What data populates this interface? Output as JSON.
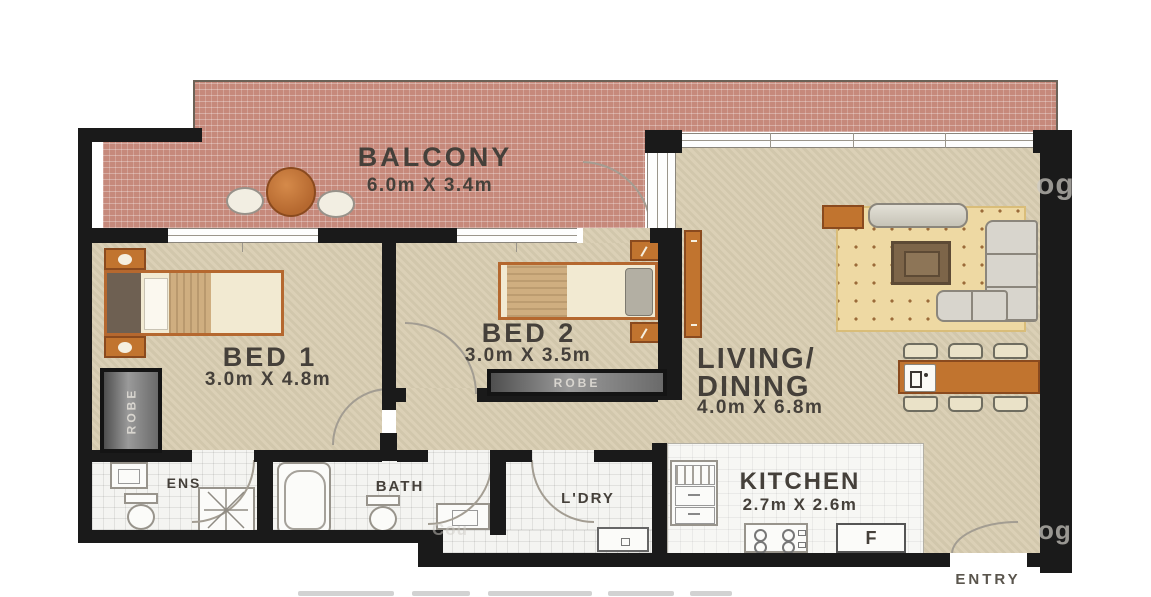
{
  "title": "apartment-floor-plan",
  "rooms": {
    "balcony": {
      "name": "BALCONY",
      "dims": "6.0m X 3.4m"
    },
    "bed1": {
      "name": "BED 1",
      "dims": "3.0m X 4.8m"
    },
    "bed2": {
      "name": "BED 2",
      "dims": "3.0m X 3.5m"
    },
    "living": {
      "name_line1": "LIVING/",
      "name_line2": "DINING",
      "dims": "4.0m X 6.8m"
    },
    "kitchen": {
      "name": "KITCHEN",
      "dims": "2.7m X 2.6m"
    },
    "ens": {
      "name": "ENS"
    },
    "bath": {
      "name": "BATH"
    },
    "ldry": {
      "name": "L'DRY"
    }
  },
  "labels": {
    "robe_bed1": "ROBE",
    "robe_bed2": "ROBE",
    "entry": "ENTRY",
    "fridge": "F"
  },
  "watermarks": {
    "top_right": "og",
    "bottom_right": "og",
    "bottom_left": "Cou"
  },
  "colors": {
    "wall": "#1a1a1a",
    "floor_tan": "#d9ceb2",
    "balcony_tile": "#c6897b",
    "wet_tile": "#f4f4f1",
    "accent_orange": "#c1742f",
    "label_text": "#45403a"
  }
}
